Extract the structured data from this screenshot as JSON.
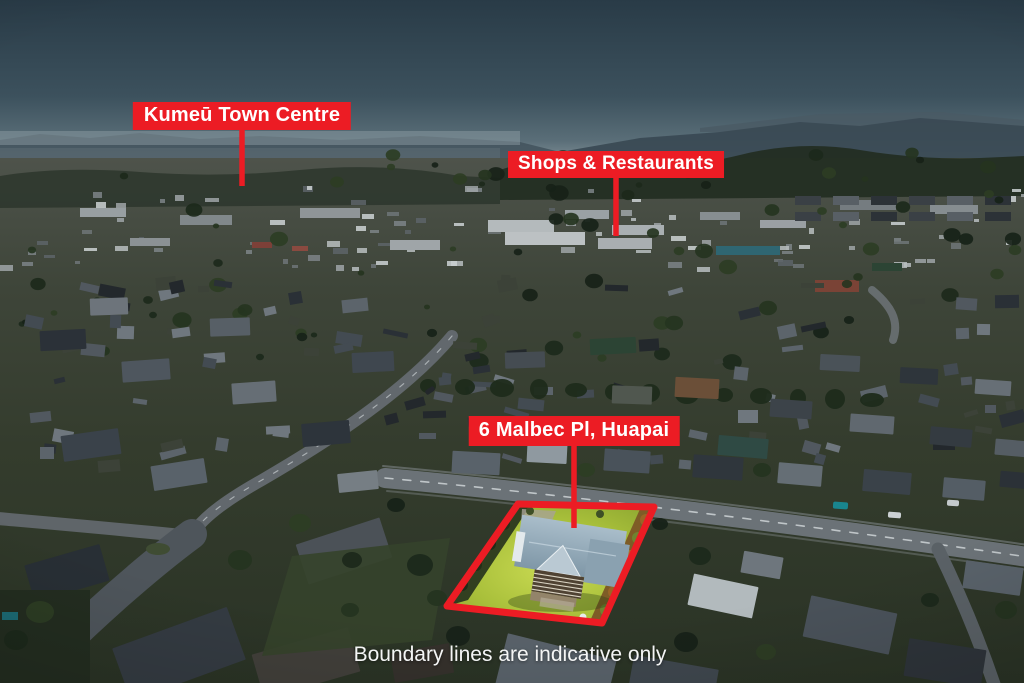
{
  "annotations": {
    "labels": [
      {
        "text": "Kumeū Town Centre"
      },
      {
        "text": "Shops & Restaurants"
      },
      {
        "text": "6 Malbec Pl, Huapai"
      }
    ],
    "disclaimer": "Boundary lines are indicative only",
    "accent_color": "#ec1c24",
    "label_text_color": "#ffffff"
  },
  "scene": {
    "sky_top_color": "#293b47",
    "sky_horizon_color": "#7d8d94",
    "highlight_lawn_color": "#b6cb45",
    "highlight_roof_color": "#a9bdca",
    "boundary_color": "#ec1c24"
  }
}
